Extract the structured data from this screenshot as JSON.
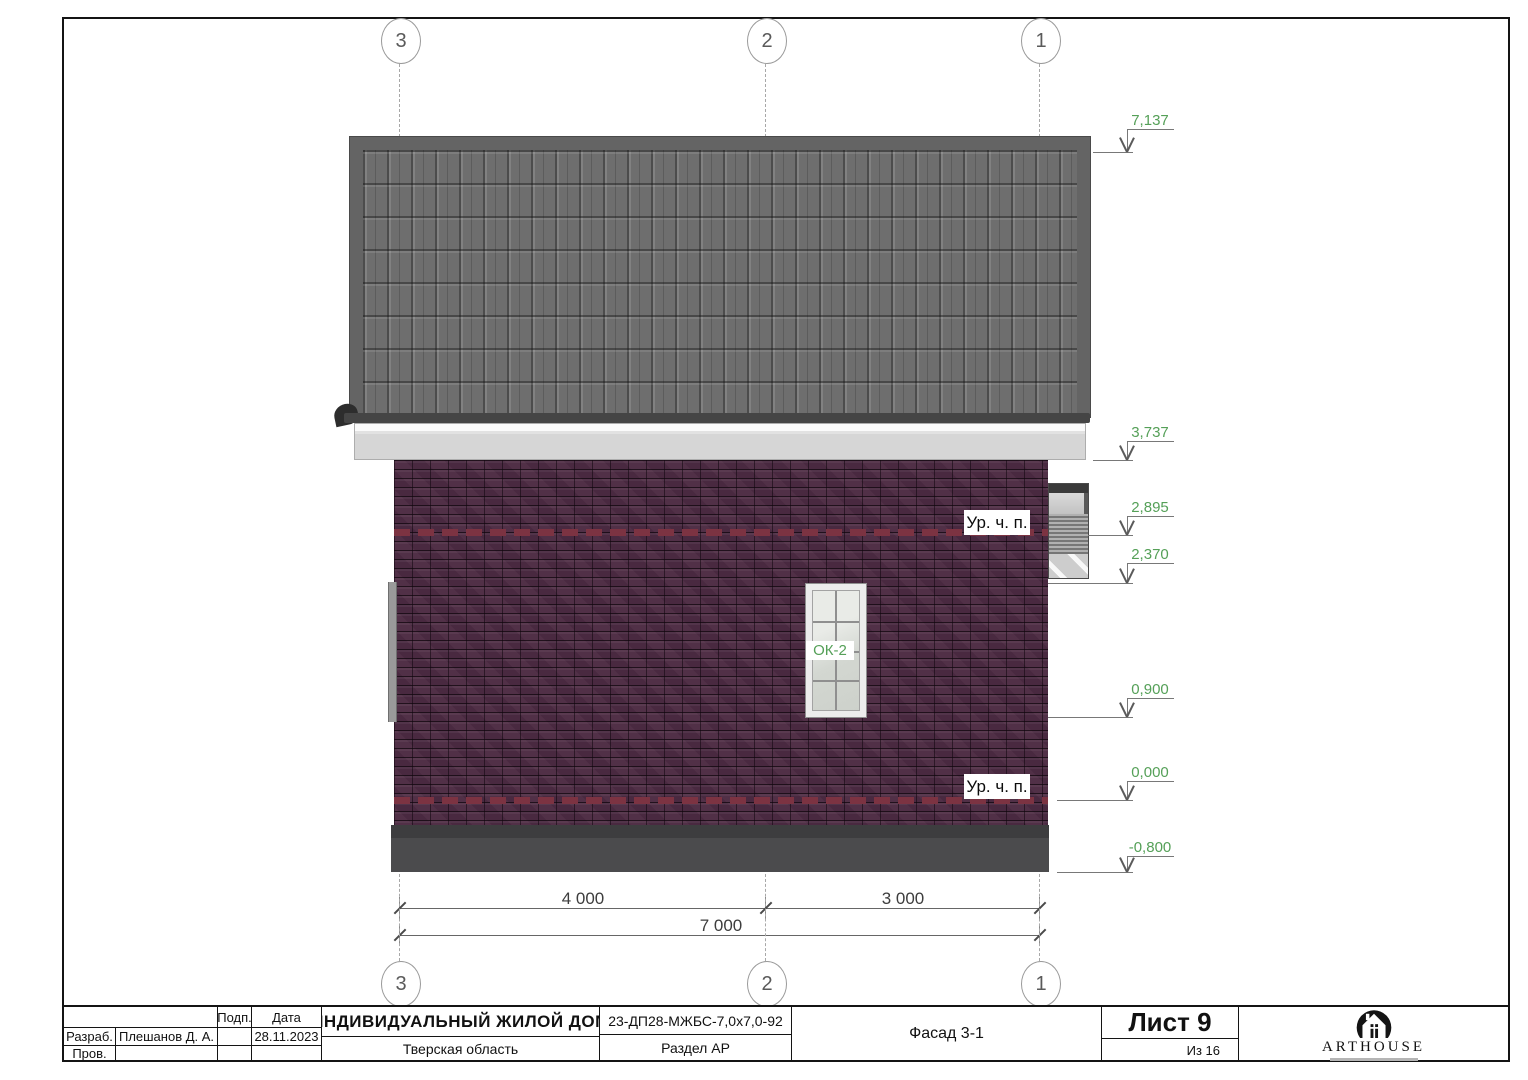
{
  "axes": {
    "top": [
      "3",
      "2",
      "1"
    ],
    "bottom": [
      "3",
      "2",
      "1"
    ]
  },
  "elevations": [
    "7,137",
    "3,737",
    "2,895",
    "2,370",
    "0,900",
    "0,000",
    "-0,800"
  ],
  "floor_levels": {
    "upper_label": "Ур. ч. п.",
    "lower_label": "Ур. ч. п."
  },
  "window": {
    "tag": "ОК-2"
  },
  "dimensions": {
    "left_span": "4 000",
    "right_span": "3 000",
    "total_span": "7 000"
  },
  "title_block": {
    "sign_header": "Подп.",
    "date_header": "Дата",
    "developed_label": "Разраб.",
    "developed_by": "Плешанов Д. А.",
    "checked_label": "Пров.",
    "date": "28.11.2023",
    "project_title": "ИНДИВИДУАЛЬНЫЙ ЖИЛОЙ ДОМ",
    "project_location": "Тверская область",
    "project_code": "23-ДП28-МЖБС-7,0х7,0-92",
    "section": "Раздел АР",
    "view_title": "Фасад 3-1",
    "sheet": "Лист 9",
    "sheet_of": "Из 16",
    "logo_text": "ARTHOUSE"
  },
  "colors": {
    "elevation_green": "#55a058",
    "brick": "#4d2b43",
    "brick_accent": "#7c3342",
    "roof": "#6e6e6e",
    "plinth": "#4b4b4d",
    "fascia": "#d6d6d6"
  }
}
